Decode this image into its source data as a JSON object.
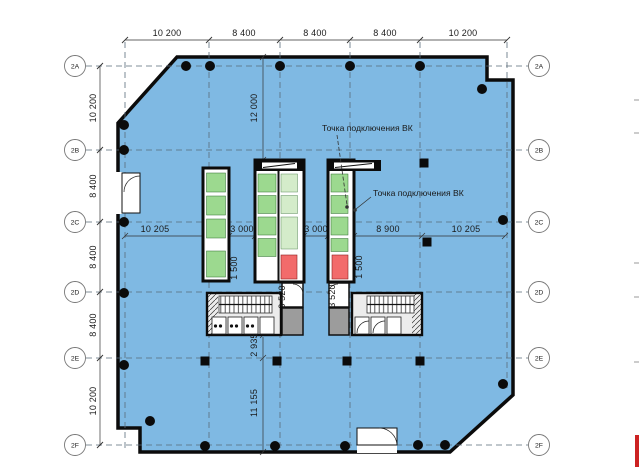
{
  "annotations": {
    "vk_point_1": "Точка подключения ВК",
    "vk_point_2": "Точка подключения ВК"
  },
  "grid": {
    "left_labels": [
      "2A",
      "2B",
      "2C",
      "2D",
      "2E",
      "2F"
    ],
    "right_labels": [
      "2A",
      "2B",
      "2C",
      "2D",
      "2E",
      "2F"
    ]
  },
  "dims": {
    "top": [
      "10 200",
      "8 400",
      "8 400",
      "8 400",
      "10 200"
    ],
    "left": [
      "10 200",
      "8 400",
      "8 400",
      "8 400",
      "10 200"
    ],
    "middle": [
      "10 205",
      "3 000",
      "3 000",
      "8 900",
      "10 205"
    ],
    "vertical": [
      "12 000",
      "2 935",
      "11 155"
    ],
    "core": {
      "left_shaft_width": "1 500",
      "left_lobby_depth": "3 520",
      "right_lobby_depth": "3 520",
      "right_shaft_width": "1 500"
    }
  },
  "colors": {
    "plan_fill": "#7FB9E3",
    "green_cell": "#9CD98F",
    "green_cell_pale": "#D4ECCA",
    "red_cell": "#F26B6B",
    "shaft_gray": "#9C9C9C",
    "wall": "#0B0B0B",
    "clip_mark_red": "#CC2222"
  }
}
